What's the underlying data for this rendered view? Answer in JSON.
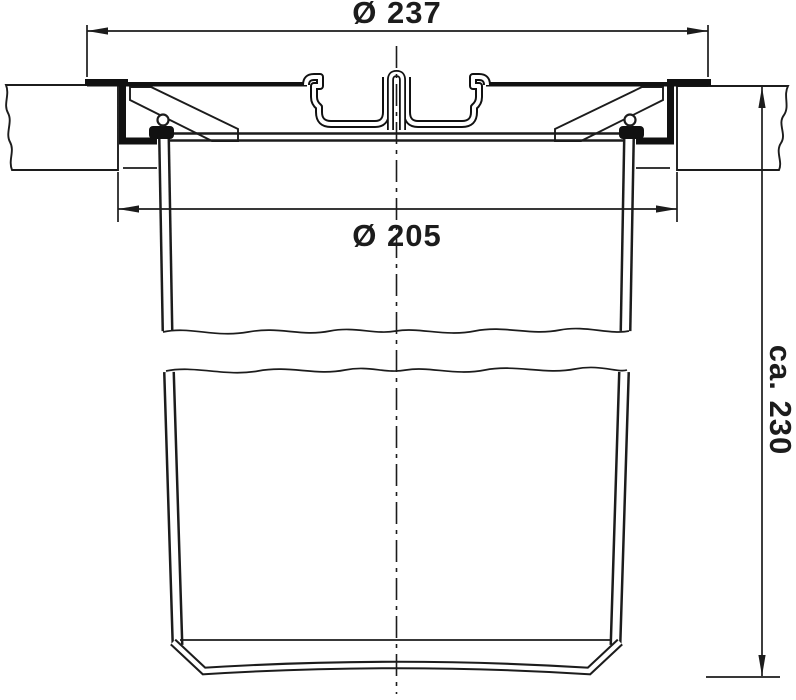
{
  "drawing": {
    "title": "built-in-bin-cross-section",
    "dimensions": {
      "outer_diameter_label": "Ø 237",
      "inner_diameter_label": "Ø 205",
      "height_label": "ca. 230"
    },
    "colors": {
      "ink": "#1c1c1c",
      "background": "#ffffff"
    }
  }
}
